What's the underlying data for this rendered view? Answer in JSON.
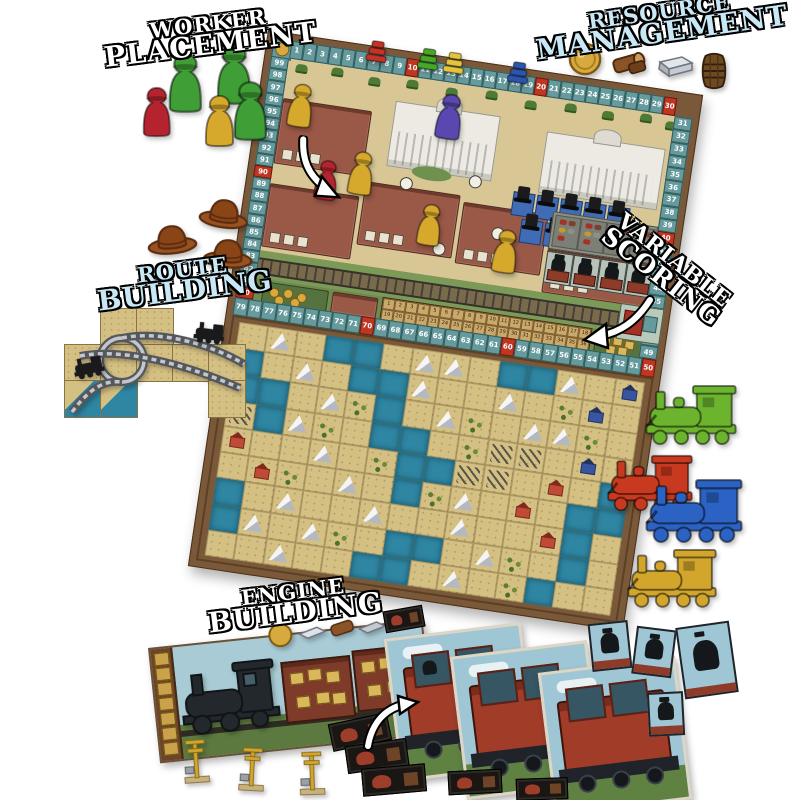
{
  "callouts": {
    "worker_placement": {
      "line1": "WORKER",
      "line2": "PLACEMENT",
      "color": "#ffffff"
    },
    "resource_management": {
      "line1": "RESOURCE",
      "line2": "MANAGEMENT",
      "color": "#c9e8f6"
    },
    "route_building": {
      "line1": "ROUTE",
      "line2": "BUILDING",
      "color": "#c9e8f6"
    },
    "variable_scoring": {
      "line1": "VARIABLE",
      "line2": "SCORING",
      "color": "#ffffff"
    },
    "engine_building": {
      "line1": "ENGINE",
      "line2": "BUILDING",
      "color": "#ffffff"
    }
  },
  "board": {
    "score_track": {
      "top": [
        1,
        2,
        3,
        4,
        5,
        6,
        7,
        8,
        9,
        10,
        11,
        12,
        13,
        14,
        15,
        16,
        17,
        18,
        19,
        20,
        21,
        22,
        23,
        24,
        25,
        26,
        27,
        28,
        29,
        30
      ],
      "right": [
        31,
        32,
        33,
        34,
        35,
        36,
        37,
        38,
        39,
        40,
        41,
        42,
        43,
        44,
        45,
        46,
        47,
        48,
        49
      ],
      "middle": [
        79,
        78,
        77,
        76,
        75,
        74,
        73,
        72,
        71,
        70,
        69,
        68,
        67,
        66,
        65,
        64,
        63,
        62,
        61,
        60,
        59,
        58,
        57,
        56,
        55,
        54,
        53,
        52,
        51,
        50
      ],
      "left": [
        99,
        98,
        97,
        96,
        95,
        94,
        93,
        92,
        91,
        90,
        89,
        88,
        87,
        86,
        85,
        84,
        83,
        82,
        81,
        80
      ],
      "cell_color": "#679a9c",
      "ten_cell_color": "#bf3722",
      "corner_icon": "gold-coin"
    },
    "engine_track": {
      "row1": [
        1,
        2,
        3,
        4,
        5,
        6,
        7,
        8,
        9,
        10,
        11,
        12,
        13,
        14,
        15,
        16,
        17,
        18
      ],
      "row2": [
        19,
        20,
        21,
        22,
        23,
        24,
        25,
        26,
        27,
        28,
        29,
        30,
        31,
        32,
        33,
        34,
        35,
        36
      ]
    },
    "score_markers": [
      {
        "color_name": "red",
        "hex": "#c43225",
        "cell": 7
      },
      {
        "color_name": "green",
        "hex": "#46a926",
        "cell": 11
      },
      {
        "color_name": "yellow",
        "hex": "#e3c43a",
        "cell": 13
      },
      {
        "color_name": "blue",
        "hex": "#2b55b4",
        "cell": 18
      }
    ],
    "board_meeples": [
      {
        "color_name": "yellow",
        "hex": "#d6a92c"
      },
      {
        "color_name": "red",
        "hex": "#b5242e"
      },
      {
        "color_name": "yellow",
        "hex": "#d6a92c"
      },
      {
        "color_name": "purple",
        "hex": "#5a48b0"
      },
      {
        "color_name": "yellow",
        "hex": "#d6a92c"
      },
      {
        "color_name": "yellow",
        "hex": "#d6a92c"
      }
    ],
    "top_hat_count": 9,
    "map": {
      "legend": {
        "D": "desert",
        "W": "water",
        "M": "mountain",
        "G": "brush",
        "R": "red-settlement",
        "B": "blue-settlement",
        "T": "track-tile"
      },
      "rows": [
        "DMDWWDMMDWWMDB",
        "WDMDWWMDDMDGBD",
        "WWDMGWDMGDMMGD",
        "TWMGDWWDGTTDBD",
        "RDDMDGWWTTDRDW",
        "DRGDMDWGMDRDWW",
        "WDMDDMDDMDDRWD",
        "WMDMGDWWDMGDWD",
        "DDMDDWWDMDGWDD"
      ]
    }
  },
  "pieces": {
    "worker_meeples": [
      {
        "color_name": "green",
        "hex": "#3f9e35"
      },
      {
        "color_name": "green",
        "hex": "#3f9e35"
      },
      {
        "color_name": "green",
        "hex": "#3f9e35"
      },
      {
        "color_name": "red",
        "hex": "#b5242e"
      },
      {
        "color_name": "yellow",
        "hex": "#d6a92c"
      }
    ],
    "resource_tokens": [
      "gold-coin",
      "wood-log",
      "steel-ingot",
      "barrel"
    ],
    "cowboy_hat_count": 3,
    "route_tile_count": 10,
    "trains": [
      {
        "color_name": "green",
        "hex": "#6cb42e"
      },
      {
        "color_name": "red",
        "hex": "#c8391f"
      },
      {
        "color_name": "blue",
        "hex": "#2b62c4"
      },
      {
        "color_name": "yellow",
        "hex": "#d2a62c"
      }
    ],
    "passenger_card_count": 3,
    "passenger_tile_count": 4,
    "black_car_tile_count": 6,
    "signal_count": 3
  }
}
